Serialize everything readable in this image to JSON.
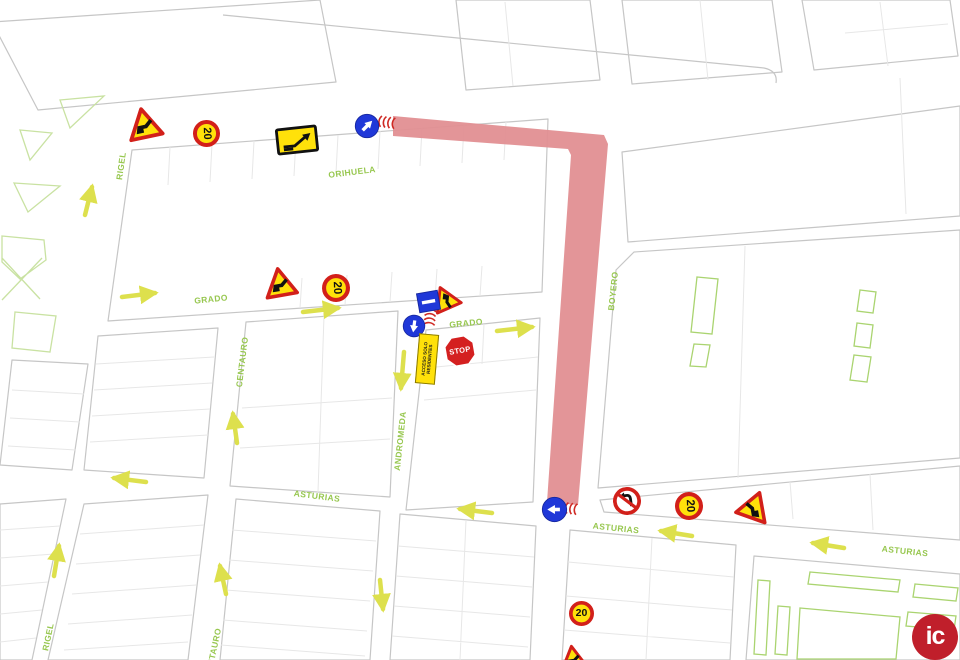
{
  "streets": {
    "labels": [
      {
        "id": "rigel-north",
        "text": "RIGEL"
      },
      {
        "id": "orihuela",
        "text": "ORIHUELA"
      },
      {
        "id": "grado-west",
        "text": "GRADO"
      },
      {
        "id": "grado-east",
        "text": "GRADO"
      },
      {
        "id": "centauro-north",
        "text": "CENTAURO"
      },
      {
        "id": "andromeda",
        "text": "ANDROMEDA"
      },
      {
        "id": "boyero",
        "text": "BOYERO"
      },
      {
        "id": "asturias-west",
        "text": "ASTURIAS"
      },
      {
        "id": "asturias-center",
        "text": "ASTURIAS"
      },
      {
        "id": "asturias-east",
        "text": "ASTURIAS"
      },
      {
        "id": "rigel-south",
        "text": "RIGEL"
      },
      {
        "id": "centauro-south",
        "text": "CENTAURO"
      }
    ]
  },
  "signs": {
    "speed_limit_value": "20",
    "stop_label": "STOP",
    "residents_panel_line1": "ACCESO SOLO",
    "residents_panel_line2": "RESIDENTES"
  },
  "logo": {
    "text": "ic"
  },
  "colors": {
    "route_pink": "#e28f92",
    "sign_yellow": "#ffe10a",
    "sign_red": "#d2201a",
    "sign_blue": "#2038d8",
    "street_label_green": "#97c74f",
    "arrow_yellow": "#dde04d",
    "logo_red": "#c01f2b"
  }
}
